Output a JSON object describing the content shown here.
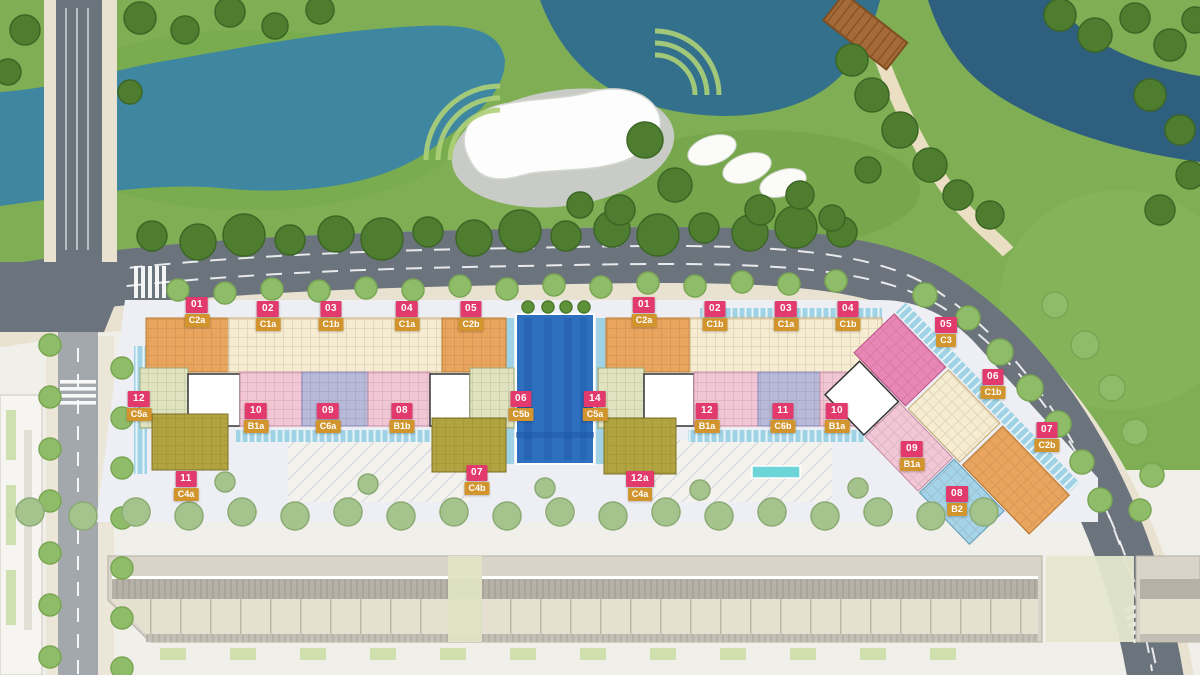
{
  "plan": {
    "type": "residential-masterplan-siteplan",
    "units": [
      {
        "num": "01",
        "code": "C2a",
        "x": 197,
        "y": 297
      },
      {
        "num": "02",
        "code": "C1a",
        "x": 268,
        "y": 301
      },
      {
        "num": "03",
        "code": "C1b",
        "x": 331,
        "y": 301
      },
      {
        "num": "04",
        "code": "C1a",
        "x": 407,
        "y": 301
      },
      {
        "num": "05",
        "code": "C2b",
        "x": 471,
        "y": 301
      },
      {
        "num": "01",
        "code": "C2a",
        "x": 644,
        "y": 297
      },
      {
        "num": "02",
        "code": "C1b",
        "x": 715,
        "y": 301
      },
      {
        "num": "03",
        "code": "C1a",
        "x": 786,
        "y": 301
      },
      {
        "num": "04",
        "code": "C1b",
        "x": 848,
        "y": 301
      },
      {
        "num": "05",
        "code": "C3",
        "x": 946,
        "y": 317
      },
      {
        "num": "06",
        "code": "C1b",
        "x": 993,
        "y": 369
      },
      {
        "num": "07",
        "code": "C2b",
        "x": 1047,
        "y": 422
      },
      {
        "num": "09",
        "code": "B1a",
        "x": 912,
        "y": 441
      },
      {
        "num": "08",
        "code": "B2",
        "x": 957,
        "y": 486
      },
      {
        "num": "12",
        "code": "C5a",
        "x": 139,
        "y": 391
      },
      {
        "num": "10",
        "code": "B1a",
        "x": 256,
        "y": 403
      },
      {
        "num": "09",
        "code": "C6a",
        "x": 328,
        "y": 403
      },
      {
        "num": "08",
        "code": "B1b",
        "x": 402,
        "y": 403
      },
      {
        "num": "06",
        "code": "C5b",
        "x": 521,
        "y": 391
      },
      {
        "num": "14",
        "code": "C5a",
        "x": 595,
        "y": 391
      },
      {
        "num": "12",
        "code": "B1a",
        "x": 707,
        "y": 403
      },
      {
        "num": "11",
        "code": "C6b",
        "x": 783,
        "y": 403
      },
      {
        "num": "10",
        "code": "B1a",
        "x": 837,
        "y": 403
      },
      {
        "num": "11",
        "code": "C4a",
        "x": 186,
        "y": 471
      },
      {
        "num": "07",
        "code": "C4b",
        "x": 477,
        "y": 465
      },
      {
        "num": "12a",
        "code": "C4a",
        "x": 640,
        "y": 471
      }
    ],
    "colors": {
      "badge_number_bg": "#e23a6d",
      "badge_code_bg": "#d2952e",
      "badge_text": "#ffffff",
      "block_orange": "#e9a55e",
      "block_cream": "#f5ecd2",
      "block_pink": "#f1c7d6",
      "block_lavender": "#b7b9da",
      "block_green": "#dfe3bf",
      "block_olive": "#b1a33f",
      "block_magenta": "#e886b6",
      "block_lightblue": "#a5d3e8",
      "block_core": "#ffffff",
      "pool_blue": "#2f6fc0",
      "water_teal": "#3f87a0",
      "water_teal_dark": "#2f5f7e",
      "channel_blue": "#9fd2e4",
      "fountain_cyan": "#6fd4d8",
      "park_green": "#7fae54",
      "tree_dark": "#4e7d30",
      "tree_light": "#8fbc68",
      "tree_sage": "#a5c38d",
      "road_gray": "#6b737d",
      "road_light": "#a3a8ad",
      "sidewalk_beige": "#e9e2d0",
      "bridge_brown": "#a46a38",
      "strip_beige": "#e6e0d1",
      "ground_pale": "#f1efe9"
    }
  }
}
